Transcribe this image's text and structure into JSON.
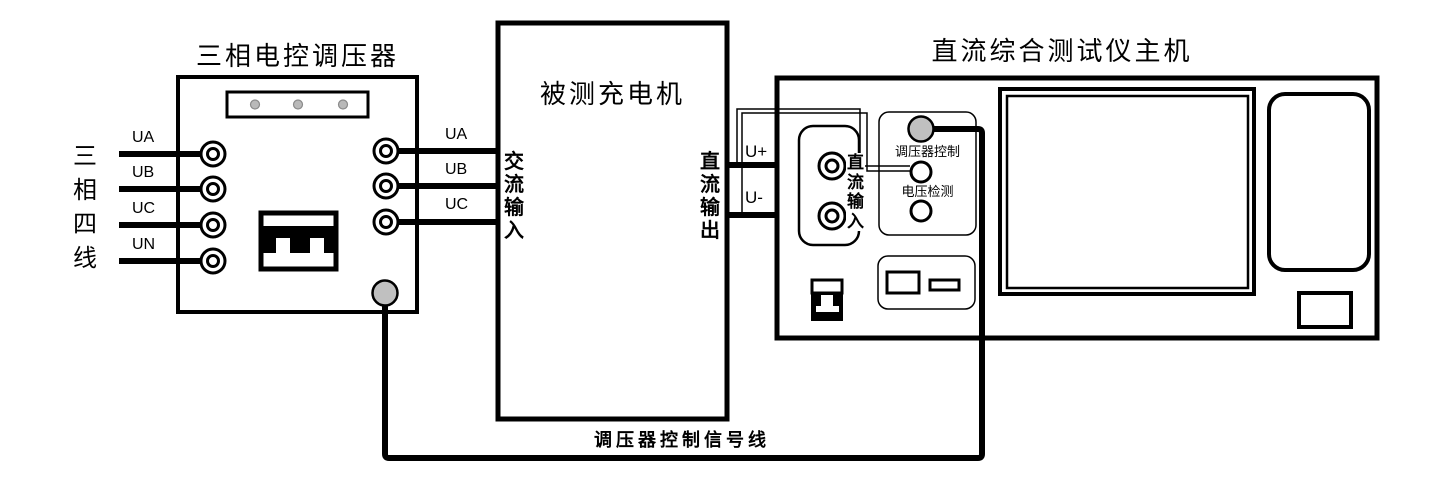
{
  "diagram": {
    "regulator": {
      "title": "三相电控调压器",
      "supply_label": "三相四线",
      "inputs": [
        "UA",
        "UB",
        "UC",
        "UN"
      ],
      "outputs": [
        "UA",
        "UB",
        "UC"
      ]
    },
    "charger": {
      "title": "被测充电机",
      "ac_input": "交流输入",
      "dc_output": "直流输出"
    },
    "tester": {
      "title": "直流综合测试仪主机",
      "dc_input": "直流输入",
      "dc_plus": "U+",
      "dc_minus": "U-",
      "regulator_control": "调压器控制",
      "voltage_detect": "电压检测"
    },
    "signal_line": "调压器控制信号线",
    "colors": {
      "line": "#000000",
      "connector_fill": "#c0c0c0",
      "indicator_fill": "#b9b9b9",
      "background": "#ffffff"
    }
  }
}
